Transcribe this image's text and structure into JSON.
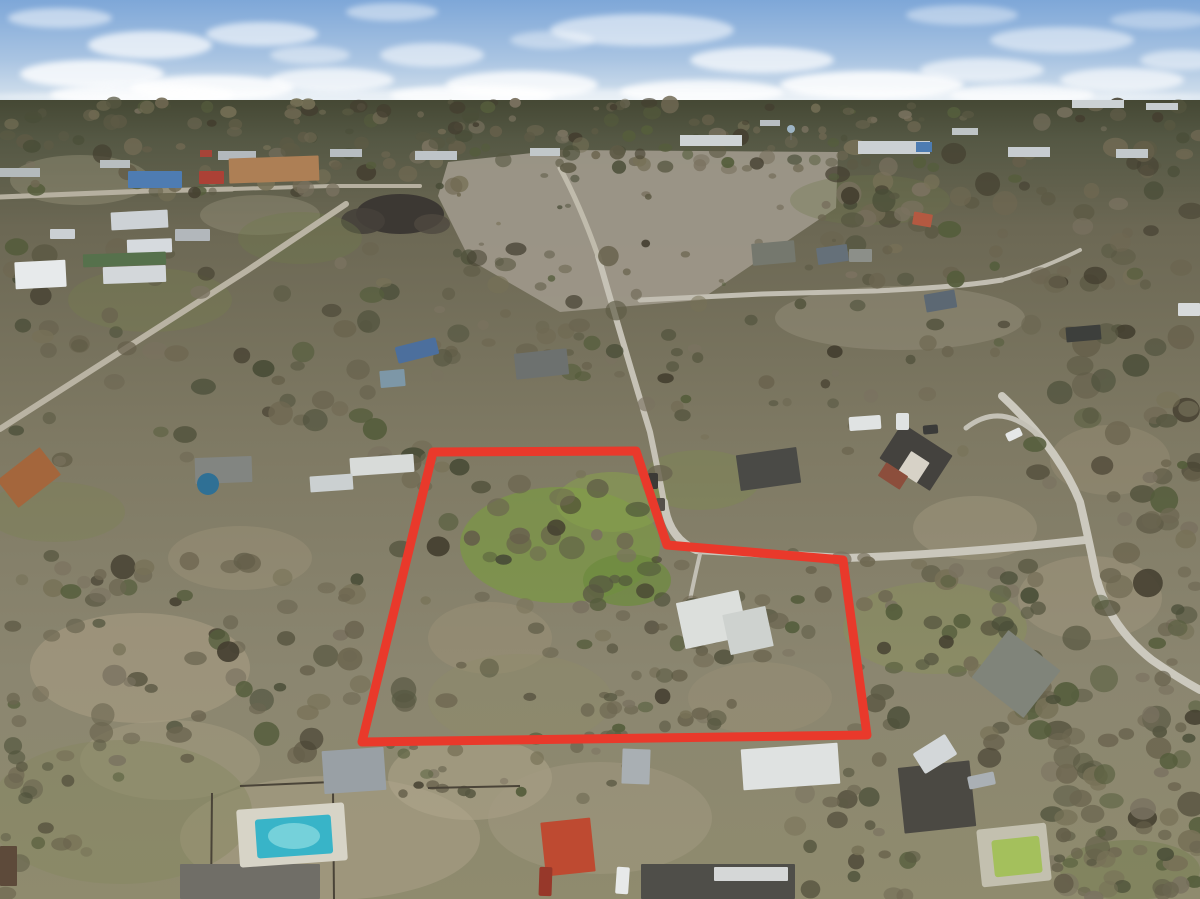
{
  "meta": {
    "description": "Aerial drone photograph of a wooded semi-rural neighborhood after storm damage, with a thick red property-boundary polygon outlining a large treed lot containing a white-roofed house and green clearing",
    "width": 1200,
    "height": 899
  },
  "scene": {
    "sky": {
      "top_color": "#7ea7d8",
      "mid_color": "#a9c4e2",
      "horizon_color": "#dde7ef",
      "horizon_y": 104
    },
    "clouds": [
      [
        60,
        18,
        52,
        10,
        0.5
      ],
      [
        150,
        45,
        62,
        14,
        0.7
      ],
      [
        262,
        34,
        56,
        12,
        0.6
      ],
      [
        92,
        74,
        72,
        14,
        0.8
      ],
      [
        212,
        88,
        82,
        13,
        0.85
      ],
      [
        332,
        80,
        62,
        12,
        0.7
      ],
      [
        432,
        55,
        52,
        12,
        0.55
      ],
      [
        522,
        85,
        76,
        14,
        0.8
      ],
      [
        642,
        30,
        92,
        16,
        0.55
      ],
      [
        762,
        60,
        72,
        13,
        0.7
      ],
      [
        872,
        85,
        92,
        14,
        0.85
      ],
      [
        702,
        92,
        82,
        12,
        0.8
      ],
      [
        982,
        70,
        62,
        12,
        0.6
      ],
      [
        1062,
        40,
        72,
        13,
        0.5
      ],
      [
        1122,
        80,
        62,
        12,
        0.65
      ],
      [
        1182,
        60,
        42,
        10,
        0.5
      ],
      [
        392,
        12,
        46,
        9,
        0.45
      ],
      [
        962,
        15,
        56,
        10,
        0.4
      ],
      [
        552,
        40,
        42,
        9,
        0.4
      ],
      [
        1022,
        95,
        72,
        11,
        0.7
      ],
      [
        142,
        95,
        92,
        12,
        0.8
      ],
      [
        472,
        96,
        82,
        11,
        0.75
      ],
      [
        600,
        97,
        620,
        8,
        0.5
      ],
      [
        1160,
        20,
        50,
        9,
        0.35
      ],
      [
        310,
        55,
        40,
        9,
        0.45
      ]
    ],
    "ground": {
      "stops": [
        [
          0,
          "#454834"
        ],
        [
          0.05,
          "#555844"
        ],
        [
          0.16,
          "#6c6854"
        ],
        [
          0.42,
          "#7e7963"
        ],
        [
          0.72,
          "#8b8670"
        ],
        [
          1,
          "#8f8b6e"
        ]
      ]
    },
    "field": {
      "name": "cleared-dirt-field",
      "points": "448,162 560,150 838,152 836,208 700,300 560,312 470,260 438,196",
      "color": "#9d9789"
    },
    "debris_piles": [
      [
        400,
        214,
        44,
        20,
        "#3a3631",
        0.95
      ],
      [
        363,
        221,
        22,
        13,
        "#45403a",
        0.9
      ],
      [
        432,
        224,
        18,
        10,
        "#4f4940",
        0.8
      ]
    ],
    "sand_patches": [
      [
        140,
        668,
        110,
        55,
        "#ab9f85",
        0.55
      ],
      [
        330,
        838,
        150,
        62,
        "#a89f86",
        0.6
      ],
      [
        470,
        778,
        82,
        42,
        "#b2a88d",
        0.5
      ],
      [
        600,
        818,
        112,
        56,
        "#a59c83",
        0.45
      ],
      [
        760,
        698,
        72,
        36,
        "#9c9279",
        0.4
      ],
      [
        1090,
        598,
        72,
        42,
        "#a39a80",
        0.45
      ],
      [
        975,
        528,
        62,
        32,
        "#a79e85",
        0.4
      ],
      [
        490,
        638,
        62,
        36,
        "#9e9278",
        0.45
      ],
      [
        240,
        558,
        72,
        32,
        "#a2987e",
        0.35
      ],
      [
        900,
        318,
        125,
        32,
        "#9a937e",
        0.45
      ],
      [
        80,
        180,
        70,
        25,
        "#9e997f",
        0.4
      ],
      [
        260,
        215,
        60,
        20,
        "#99947c",
        0.4
      ],
      [
        1110,
        460,
        60,
        35,
        "#9a9179",
        0.4
      ],
      [
        170,
        760,
        90,
        40,
        "#a39b82",
        0.5
      ]
    ],
    "grass_patches": [
      [
        560,
        545,
        100,
        58,
        "#7b9746",
        0.75
      ],
      [
        612,
        502,
        56,
        30,
        "#87a04c",
        0.55
      ],
      [
        627,
        580,
        44,
        26,
        "#6e8b3f",
        0.75
      ],
      [
        935,
        628,
        92,
        46,
        "#8a9458",
        0.4
      ],
      [
        120,
        812,
        132,
        72,
        "#84875f",
        0.45
      ],
      [
        520,
        700,
        92,
        46,
        "#8f8c68",
        0.35
      ],
      [
        300,
        238,
        62,
        26,
        "#6f7a4a",
        0.35
      ],
      [
        150,
        300,
        82,
        32,
        "#767f4e",
        0.35
      ],
      [
        700,
        480,
        60,
        30,
        "#7d8a50",
        0.4
      ],
      [
        55,
        512,
        70,
        30,
        "#7d8355",
        0.4
      ],
      [
        870,
        200,
        80,
        25,
        "#6d764a",
        0.3
      ],
      [
        1130,
        870,
        70,
        30,
        "#6f7a48",
        0.4
      ]
    ],
    "roads": [
      [
        "road-upper-left",
        "M0,197 L148,191 L232,189",
        "#b6b0a0",
        5
      ],
      [
        "road-commercial",
        "M232,189 L330,186 L420,186",
        "#b6b0a0",
        4
      ],
      [
        "road-left-diagonal",
        "M0,429 L120,352 L248,270 L346,204",
        "#b9b3a3",
        6
      ],
      [
        "road-north-south",
        "M598,256 Q622,340 650,432 Q658,470 664,502",
        "#c6c2b6",
        6
      ],
      [
        "road-north-continue",
        "M598,256 Q580,205 560,168",
        "#c0bbac",
        5
      ],
      [
        "road-east-west",
        "M664,502 Q668,538 696,550 L846,558 Q958,554 1085,540",
        "#cac7bc",
        8
      ],
      [
        "road-main-curve",
        "M1002,396 Q1058,448 1080,502 Q1090,545 1096,576 Q1108,625 1152,660 Q1178,678 1200,690",
        "#ccc9be",
        8
      ],
      [
        "road-loop-driveway",
        "M966,428 Q1002,400 1040,437",
        "#c4c1b6",
        5
      ],
      [
        "road-upper-residential",
        "M640,300 L762,294 L874,291 Q960,287 1002,280",
        "#c2beb2",
        5
      ],
      [
        "road-up-right",
        "M1002,280 Q1040,270 1080,250",
        "#bfbbae",
        4
      ],
      [
        "driveway-white-house",
        "M700,554 Q694,580 690,600",
        "#c2bfb4",
        4
      ]
    ],
    "tree_palette": [
      "#4a4e38",
      "#575741",
      "#655f4a",
      "#6f6852",
      "#555d3c",
      "#6b6550",
      "#443f30",
      "#777157",
      "#5d5a45",
      "#7a7260"
    ],
    "tree_clusters": [
      [
        "horizon-forest",
        0,
        102,
        1200,
        40,
        110,
        3,
        9,
        0
      ],
      [
        "top-mid-band",
        440,
        128,
        410,
        42,
        40,
        4,
        9,
        0
      ],
      [
        "upper-left-band",
        0,
        136,
        460,
        58,
        55,
        4,
        10,
        0
      ],
      [
        "upper-right-forest",
        828,
        146,
        372,
        140,
        85,
        5,
        13,
        0
      ],
      [
        "mid-center-trees",
        435,
        242,
        270,
        135,
        45,
        5,
        11,
        0
      ],
      [
        "left-mid-trees",
        0,
        246,
        440,
        218,
        65,
        6,
        13,
        0
      ],
      [
        "mid-right-sparse",
        640,
        298,
        370,
        155,
        32,
        4,
        9,
        0
      ],
      [
        "polygon-left-trees",
        393,
        453,
        272,
        262,
        50,
        5,
        13,
        0
      ],
      [
        "polygon-right-trees",
        655,
        553,
        215,
        172,
        38,
        5,
        11,
        0
      ],
      [
        "right-forest",
        1028,
        318,
        172,
        562,
        85,
        6,
        15,
        0
      ],
      [
        "right-mid-forest",
        853,
        553,
        207,
        207,
        48,
        6,
        12,
        0
      ],
      [
        "bottom-left-forest",
        0,
        553,
        367,
        207,
        75,
        6,
        13,
        0
      ],
      [
        "bottom-left-corner-trees",
        0,
        745,
        125,
        154,
        22,
        5,
        11,
        0
      ],
      [
        "center-bottom-trees",
        583,
        633,
        142,
        127,
        26,
        5,
        10,
        0
      ],
      [
        "bottom-center-trees",
        373,
        733,
        262,
        67,
        22,
        4,
        9,
        0
      ],
      [
        "bottom-center-right-trees",
        793,
        758,
        122,
        141,
        25,
        5,
        11,
        0
      ],
      [
        "field-debris",
        450,
        166,
        385,
        128,
        24,
        2,
        5,
        0
      ],
      [
        "bottom-right-trees",
        1052,
        733,
        148,
        166,
        36,
        6,
        13,
        1
      ],
      [
        "edge-right-fg",
        1148,
        348,
        52,
        402,
        20,
        5,
        11,
        1
      ],
      [
        "palms-green-pool",
        1038,
        812,
        64,
        64,
        8,
        4,
        8,
        1
      ]
    ],
    "distant_buildings": [
      [
        680,
        135,
        62,
        11,
        "#ced3d5"
      ],
      [
        858,
        141,
        72,
        13,
        "#cbd0d3"
      ],
      [
        916,
        142,
        16,
        10,
        "#4d7cb2"
      ],
      [
        1008,
        147,
        42,
        10,
        "#c7ccd0"
      ],
      [
        1116,
        149,
        32,
        9,
        "#c3c9cc"
      ],
      [
        415,
        151,
        42,
        9,
        "#bec4c8"
      ],
      [
        330,
        149,
        32,
        8,
        "#b7bdc1"
      ],
      [
        218,
        151,
        38,
        9,
        "#b3b9bd"
      ],
      [
        200,
        150,
        12,
        7,
        "#a64438"
      ],
      [
        530,
        148,
        30,
        8,
        "#c2c8ca"
      ],
      [
        760,
        120,
        20,
        6,
        "#b8bec2"
      ],
      [
        1072,
        100,
        52,
        8,
        "#ccd2d4"
      ],
      [
        1146,
        103,
        32,
        7,
        "#c7cdd0"
      ],
      [
        952,
        128,
        26,
        7,
        "#bec4c6"
      ],
      [
        100,
        160,
        30,
        8,
        "#b8bec0"
      ],
      [
        0,
        168,
        40,
        9,
        "#b4babc"
      ]
    ],
    "water_tower": {
      "x": 791,
      "y": 129,
      "r": 4,
      "color": "#9db4c4",
      "leg_color": "#6a6a62"
    },
    "buildings": [
      [
        "warehouse-blue",
        128,
        171,
        54,
        17,
        "#4e7cb2",
        0
      ],
      [
        "building-red",
        199,
        171,
        25,
        13,
        "#ac4136",
        0
      ],
      [
        "building-tan-complex",
        229,
        157,
        90,
        25,
        "#ad7f55",
        -2
      ],
      [
        "warehouse-white-1",
        111,
        211,
        57,
        18,
        "#cdd2d6",
        -3
      ],
      [
        "warehouse-white-2",
        127,
        239,
        45,
        14,
        "#d6dade",
        -2
      ],
      [
        "building-green-roof",
        83,
        253,
        83,
        13,
        "#56714c",
        -2
      ],
      [
        "warehouse-white-3",
        103,
        266,
        63,
        17,
        "#d3d7da",
        -2
      ],
      [
        "barn-arch-white",
        15,
        261,
        51,
        27,
        "#e7eaeb",
        -3
      ],
      [
        "shed-gray-upper-left",
        175,
        229,
        35,
        12,
        "#b2b7bb",
        0
      ],
      [
        "building-white-small",
        50,
        229,
        25,
        10,
        "#cbd0d4",
        0
      ],
      [
        "house-gray-north",
        752,
        242,
        43,
        22,
        "#75786e",
        -5
      ],
      [
        "house-bluegray-1",
        817,
        246,
        31,
        17,
        "#657079",
        -8
      ],
      [
        "house-red-roof-north",
        913,
        213,
        19,
        13,
        "#b45941",
        10
      ],
      [
        "house-bluegray-2",
        925,
        292,
        31,
        18,
        "#5c6873",
        -10
      ],
      [
        "house-gray-small-north",
        849,
        249,
        23,
        13,
        "#8c8f89",
        0
      ],
      [
        "house-dark-northeast",
        1066,
        326,
        35,
        15,
        "#3d3f3c",
        -5
      ],
      [
        "house-white-northeast",
        1178,
        303,
        22,
        13,
        "#d7dadb",
        0
      ],
      [
        "house-gray-center",
        515,
        351,
        53,
        26,
        "#6d716f",
        -6
      ],
      [
        "shed-lightblue-west",
        380,
        370,
        25,
        17,
        "#7d97a7",
        -5
      ],
      [
        "house-dark-center",
        738,
        451,
        61,
        36,
        "#4a4a46",
        -8
      ],
      [
        "house-brick-roof",
        886,
        436,
        60,
        42,
        "#44423e",
        33
      ],
      [
        "house-brick-gable",
        903,
        455,
        22,
        24,
        "#d7d2c7",
        33
      ],
      [
        "house-brick-wall",
        880,
        468,
        26,
        16,
        "#8c4e3c",
        33
      ],
      [
        "barn-white-west",
        350,
        456,
        64,
        18,
        "#d8dbd9",
        -4
      ],
      [
        "shed-white-west",
        310,
        475,
        43,
        16,
        "#cbd0d1",
        -4
      ],
      [
        "house-gray-west",
        195,
        457,
        57,
        26,
        "#828581",
        -2
      ],
      [
        "house-orange-west",
        2,
        460,
        54,
        35,
        "#a4663c",
        -38
      ],
      [
        "house-white-metal",
        680,
        596,
        64,
        47,
        "#dcdfdc",
        -12
      ],
      [
        "house-white-metal-wing",
        726,
        610,
        44,
        41,
        "#ced2cf",
        -12
      ],
      [
        "shed-gray-bottom",
        622,
        749,
        28,
        35,
        "#a9afb3",
        2
      ],
      [
        "building-white-bottom",
        742,
        746,
        97,
        41,
        "#dfe2e1",
        -4
      ],
      [
        "house-red-bottom",
        543,
        820,
        50,
        54,
        "#be4a31",
        -6
      ],
      [
        "house-dark-bottom",
        641,
        864,
        154,
        35,
        "#4f4e49",
        0
      ],
      [
        "house-dark-bottom-white-wing",
        714,
        867,
        74,
        14,
        "#d5d7d7",
        0
      ],
      [
        "house-gray-bottom-left",
        180,
        864,
        140,
        35,
        "#706e67",
        0
      ],
      [
        "barn-gray-bottom-left",
        323,
        749,
        62,
        43,
        "#99a0a5",
        -4
      ],
      [
        "barn-quonset",
        983,
        644,
        66,
        60,
        "#80847a",
        38
      ],
      [
        "house-dark-bottom-right",
        901,
        764,
        72,
        66,
        "#4b4943",
        -6
      ],
      [
        "structure-brown-bottom-left",
        0,
        846,
        17,
        40,
        "#5d4a3a",
        0
      ]
    ],
    "fences": {
      "color": "#4a4438",
      "width": 2,
      "lines": [
        [
          212,
          793,
          211,
          899
        ],
        [
          240,
          786,
          332,
          782
        ],
        [
          333,
          790,
          334,
          899
        ],
        [
          428,
          788,
          520,
          786
        ]
      ]
    },
    "pools": {
      "swimming_pool_left": {
        "deck": [
          238,
          806,
          108,
          58,
          -4,
          "#d7d4c7"
        ],
        "water": [
          256,
          817,
          76,
          39,
          -4,
          "#38b4c8"
        ],
        "highlight": [
          294,
          836,
          26,
          13,
          "#85d8df",
          0.8
        ]
      },
      "green_pool_right": {
        "deck": [
          979,
          826,
          70,
          58,
          -6,
          "#c3c0af"
        ],
        "water": [
          993,
          838,
          48,
          37,
          -6,
          "#a4c05c"
        ]
      },
      "above_ground_pool": {
        "cx": 208,
        "cy": 484,
        "r": 11,
        "color": "#2f7095"
      }
    },
    "vehicles": [
      [
        "car-white-bottom",
        616,
        867,
        13,
        27,
        "#e7e9e9",
        4
      ],
      [
        "truck-red-bottom",
        539,
        867,
        13,
        29,
        "#97382a",
        2
      ],
      [
        "truck-white-right",
        916,
        742,
        38,
        24,
        "#d3d7d9",
        -32
      ],
      [
        "car-gray-right",
        968,
        774,
        27,
        13,
        "#aab0b5",
        -12
      ],
      [
        "rv-white",
        849,
        416,
        32,
        14,
        "#e0e3e3",
        -4
      ],
      [
        "trailer-white",
        896,
        413,
        13,
        17,
        "#dfe2e2",
        0
      ],
      [
        "car-dark",
        923,
        425,
        15,
        9,
        "#3b3b39",
        -5
      ],
      [
        "car-white-driveway",
        1006,
        430,
        16,
        9,
        "#e5e7e7",
        -25
      ],
      [
        "truck-blue-left",
        396,
        342,
        42,
        17,
        "#4c6f9d",
        -14
      ],
      [
        "road-debris-1",
        648,
        473,
        10,
        16,
        "#3c3a36",
        0
      ],
      [
        "road-debris-2",
        656,
        498,
        9,
        13,
        "#55504a",
        0
      ]
    ],
    "boundary": {
      "name": "property-boundary-outline",
      "points": [
        [
          433,
          452
        ],
        [
          636,
          451
        ],
        [
          667,
          545
        ],
        [
          843,
          560
        ],
        [
          867,
          735
        ],
        [
          362,
          742
        ]
      ],
      "color": "#e9392b",
      "width": 9
    }
  }
}
